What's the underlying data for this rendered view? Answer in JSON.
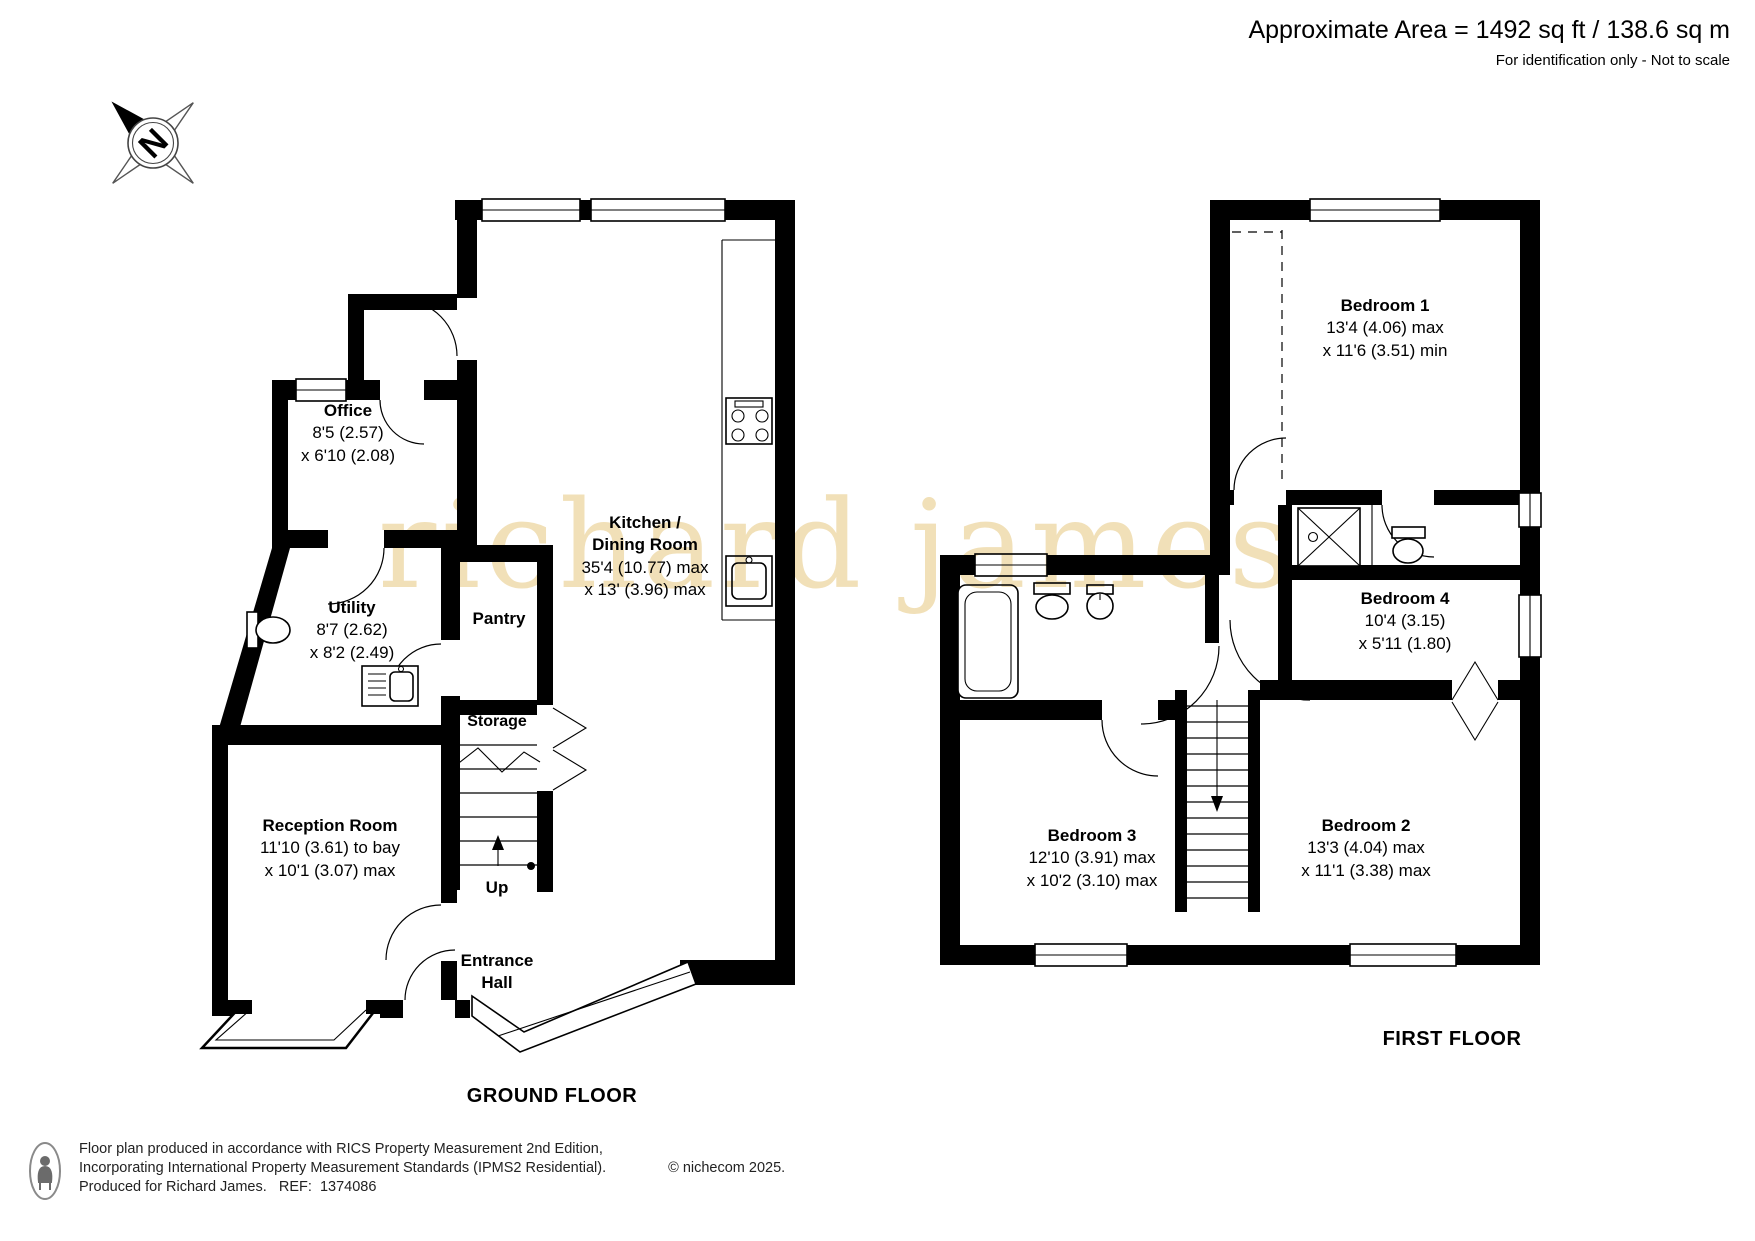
{
  "header": {
    "area": "Approximate Area = 1492 sq ft / 138.6 sq m",
    "note": "For identification only - Not to scale"
  },
  "compass": {
    "letter": "N"
  },
  "watermark": {
    "text": "richard james",
    "color": "#f1e0b8"
  },
  "ground": {
    "title": "GROUND FLOOR",
    "office": {
      "name": "Office",
      "l1": "8'5 (2.57)",
      "l2": "x 6'10 (2.08)"
    },
    "utility": {
      "name": "Utility",
      "l1": "8'7 (2.62)",
      "l2": "x 8'2 (2.49)"
    },
    "pantry": {
      "name": "Pantry"
    },
    "kitchen": {
      "name1": "Kitchen /",
      "name2": "Dining Room",
      "l1": "35'4 (10.77) max",
      "l2": "x 13' (3.96) max"
    },
    "storage": {
      "name": "Storage"
    },
    "up": {
      "label": "Up"
    },
    "reception": {
      "name": "Reception Room",
      "l1": "11'10 (3.61) to bay",
      "l2": "x 10'1 (3.07) max"
    },
    "entrance": {
      "name1": "Entrance",
      "name2": "Hall"
    }
  },
  "first": {
    "title": "FIRST FLOOR",
    "bedroom1": {
      "name": "Bedroom 1",
      "l1": "13'4 (4.06) max",
      "l2": "x 11'6 (3.51) min"
    },
    "bedroom4": {
      "name": "Bedroom 4",
      "l1": "10'4 (3.15)",
      "l2": "x 5'11 (1.80)"
    },
    "bedroom3": {
      "name": "Bedroom 3",
      "l1": "12'10 (3.91) max",
      "l2": "x 10'2 (3.10) max"
    },
    "bedroom2": {
      "name": "Bedroom 2",
      "l1": "13'3 (4.04) max",
      "l2": "x 11'1 (3.38) max"
    }
  },
  "footer": {
    "line1": "Floor plan produced in accordance with RICS Property Measurement 2nd Edition,",
    "line2": "Incorporating International Property Measurement Standards (IPMS2 Residential).",
    "copyright": "© nichecom 2025.",
    "line3": "Produced for Richard James.   REF:  1374086"
  },
  "colors": {
    "walls": "#000000",
    "watermark": "#f1e0b8"
  }
}
